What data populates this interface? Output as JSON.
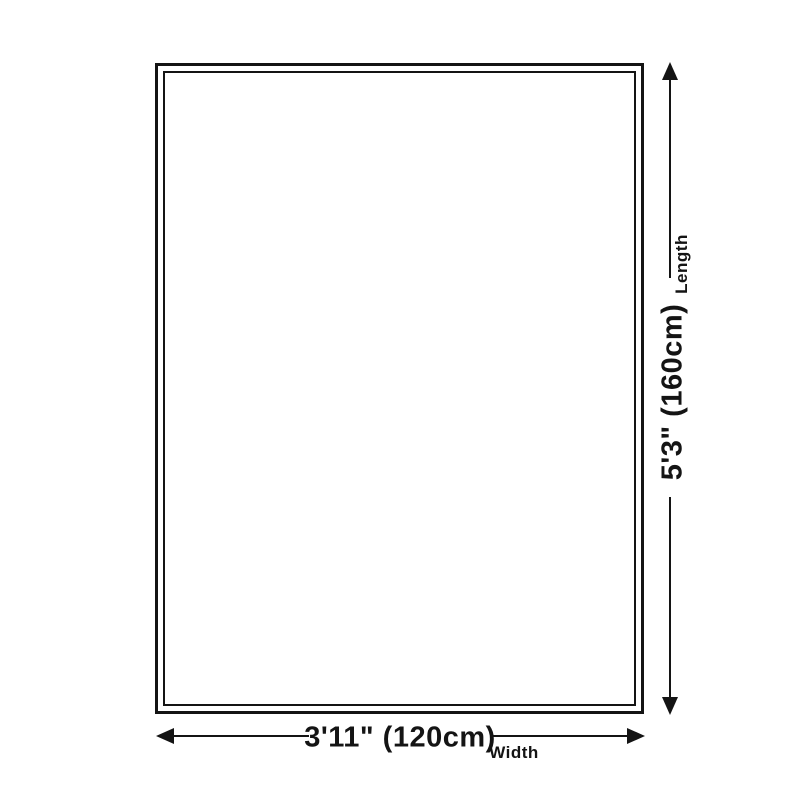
{
  "diagram": {
    "type": "rug-size-diagram",
    "background_color": "#ffffff",
    "line_color": "#141414",
    "rug": {
      "fill": "#ffffff",
      "border_color": "#141414",
      "border_style": "double"
    },
    "length": {
      "label": "Length",
      "value": "5'3\" (160cm)"
    },
    "width": {
      "label": "Width",
      "value": "3'11\" (120cm)"
    }
  }
}
